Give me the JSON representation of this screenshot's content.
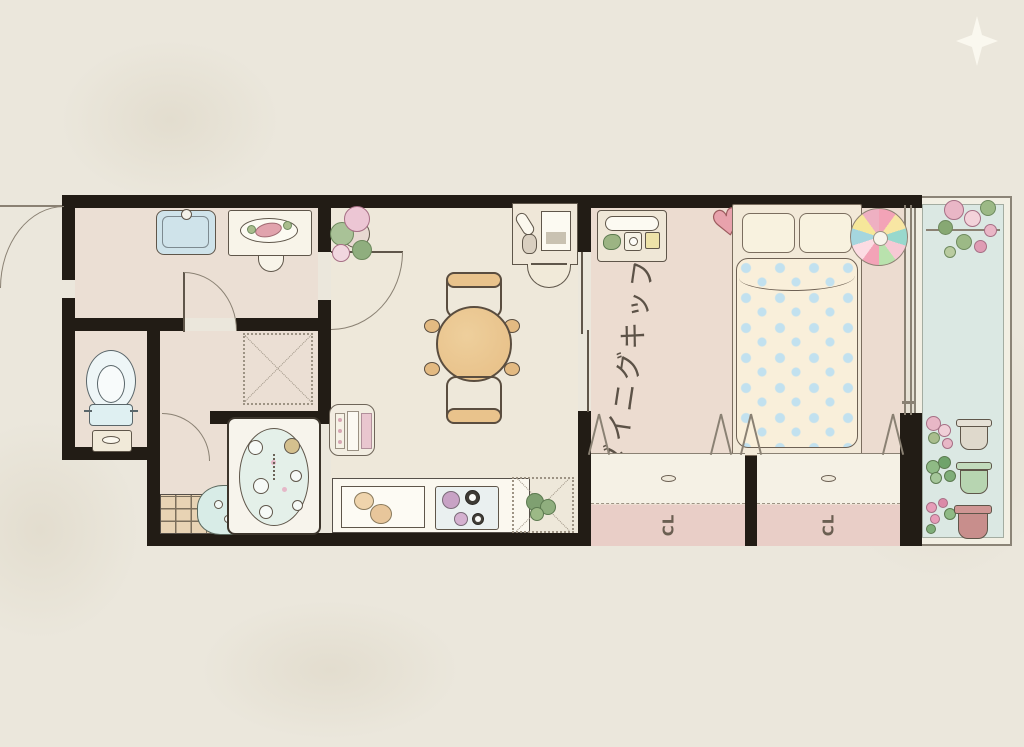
{
  "background": {
    "paper_color": "#ebe7dc",
    "sparkle_icon": "four-point-star",
    "sparkle_color": "#fbf9ef"
  },
  "plan": {
    "type": "apartment-floor-plan-illustration",
    "wall_color": "#221c15",
    "labels": {
      "bedroom_area": "ダイニグキッフ",
      "closet_left": "CL",
      "closet_right": "CL"
    },
    "css_vars": {
      "paper": "#ebe7dc",
      "wall": "#221c15",
      "ink": "#5f564a",
      "ink2": "#8a8173",
      "floor-warm": "#ebdfd4",
      "floor-cream": "#eee8da",
      "floor-bedroom": "#ecdcd0",
      "balcony-floor": "#dbe8e3",
      "closet-base": "#e9cec7",
      "closet-door": "#f5f1e5",
      "label-ink": "#5c5247",
      "water-blue": "#cfe3ea",
      "bath-water": "#e4f0e9",
      "wood": "#e9c38c",
      "blanket": "#f9efda",
      "dot-blue": "#c2e1ef",
      "heart": "#e8a2ac"
    },
    "beach_ball_segments": [
      "#f3a3b7",
      "#f8e6a3",
      "#98d8cd",
      "#f6c9d4",
      "#b9e2ad",
      "#f3a3b7",
      "#fcdce3",
      "#a5d6de",
      "#f6e79a",
      "#eeb0c2"
    ],
    "rooms": [
      {
        "name": "powder-room",
        "floor_color": "#ebdfd4",
        "items": [
          "wash-basin-blue",
          "vanity-counter-with-plate",
          "stool",
          "hinged-door"
        ]
      },
      {
        "name": "toilet-room",
        "floor_color": "#ebdfd4",
        "items": [
          "toilet-top-view",
          "toilet-cabinet"
        ]
      },
      {
        "name": "changing-area",
        "floor_color": "#ebdfd4",
        "items": [
          "dashed-floor-mat"
        ]
      },
      {
        "name": "bathroom",
        "floor_color": "#ebdfd4",
        "items": [
          "bathtub-with-bubbles",
          "wash-bowl",
          "tiled-floor",
          "hinged-door"
        ]
      },
      {
        "name": "living-dining-kitchen",
        "floor_color": "#eee8da",
        "items": [
          "potted-plant",
          "hinged-door",
          "round-dining-table",
          "dining-chair-top",
          "dining-chair-bottom",
          "washing-machine",
          "kitchen-sink-with-fruit",
          "cooktop-stove",
          "herb-mat",
          "desk-with-tablet",
          "desk-chair"
        ]
      },
      {
        "name": "bedroom",
        "label": "ダイニグキッフ",
        "floor_color": "#ecdcd0",
        "items": [
          "nightstand-with-tray",
          "heart-cushion",
          "double-bed-with-polkadot-blanket",
          "two-pillows",
          "beach-ball-color-wheel",
          "sliding-door",
          "window-to-balcony"
        ]
      },
      {
        "name": "closet-left",
        "label": "CL",
        "door_color": "#f5f1e5",
        "base_color": "#e9cec7",
        "items": [
          "folding-door-marks",
          "door-handle"
        ]
      },
      {
        "name": "closet-right",
        "label": "CL",
        "door_color": "#f5f1e5",
        "base_color": "#e9cec7",
        "items": [
          "folding-door-marks",
          "door-handle"
        ]
      },
      {
        "name": "balcony",
        "floor_color": "#dbe8e3",
        "items": [
          "flower-bouquet",
          "railing",
          "flower-pot-white",
          "succulent-pot-green",
          "tulip-pot-pink"
        ]
      }
    ]
  }
}
